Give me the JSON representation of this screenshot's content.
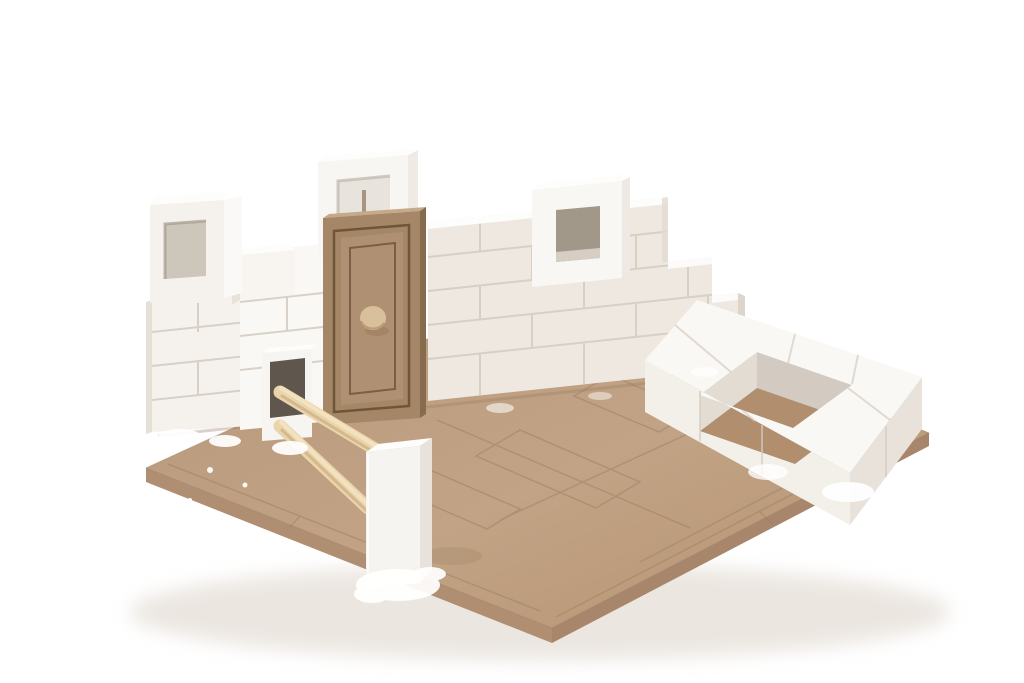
{
  "scene": {
    "type": "product-photo",
    "subject": "Miniature brick construction kit model",
    "description": "A partially built miniature model: stepped walls of small white plaster bricks glued on a tan MDF base board with scored paving lines. A wooden MDF door with a round dowel knob stands in the wall under a white window-frame brick; two more white window-frame bricks top the wall. At the right is a single-course square brick foundation; at the front-left two wooden dowel rails run from a pierced corner brick to a white fence post. White glue residue is visible at joints. Pure white studio background.",
    "objects": [
      {
        "name": "mdf-base-board",
        "label": "MDF base board with scored paving lines"
      },
      {
        "name": "brick-wall",
        "label": "Stepped wall of white miniature plaster bricks"
      },
      {
        "name": "door",
        "label": "Wooden MDF door with frame and dowel knob"
      },
      {
        "name": "transom-window-frame",
        "label": "White window-frame brick above the door"
      },
      {
        "name": "left-window-frame",
        "label": "White window-frame brick on left wall top"
      },
      {
        "name": "middle-window-frame",
        "label": "White window-frame brick mid-wall"
      },
      {
        "name": "square-foundation",
        "label": "Single-course square brick foundation ring"
      },
      {
        "name": "fence",
        "label": "Two wooden dowel rails ending at a white post"
      },
      {
        "name": "glue-residue",
        "label": "White plaster glue residue at joints"
      }
    ]
  },
  "palette": {
    "background": "#ffffff",
    "contact_shadow": "#d8cec2",
    "base_top": "#bfa083",
    "base_side_left": "#b08e72",
    "base_side_right": "#a8866b",
    "base_score": "#9c8065",
    "wall_contact": "#9a7e63",
    "brick_face": "#f5f2ed",
    "brick_face_shaded": "#eee8e1",
    "brick_top": "#fdfdfb",
    "brick_side": "#e6dfd6",
    "brick_joint": "#d5ccc2",
    "end_face": "#ddd5cb",
    "window_hole_left": "#cdc6ba",
    "window_hole_mid": "#a2988a",
    "window_hole_mid_light": "#d6cec2",
    "transom_hole": "#e8e3dc",
    "corner_hole": "#5f574d",
    "door_frame": "#a58768",
    "door_frame_top": "#c4aa8b",
    "door_frame_side": "#876b4e",
    "door_groove": "#6f5639",
    "door_panel": "#af9072",
    "door_knob": "#d9c09c",
    "door_knob_edge": "#b3946c",
    "dowel": "#ead4ab",
    "dowel_highlight": "#f4e4c3",
    "dowel_shade": "#cfb287",
    "glue": "#ffffff",
    "ring_top": "#faf8f5",
    "ring_face_left": "#f3efe9",
    "ring_face_right": "#e8e2da",
    "ring_inner_left": "#e3dcd3",
    "ring_inner_right": "#d3cbc1",
    "ring_floor": "#b08e6e"
  }
}
